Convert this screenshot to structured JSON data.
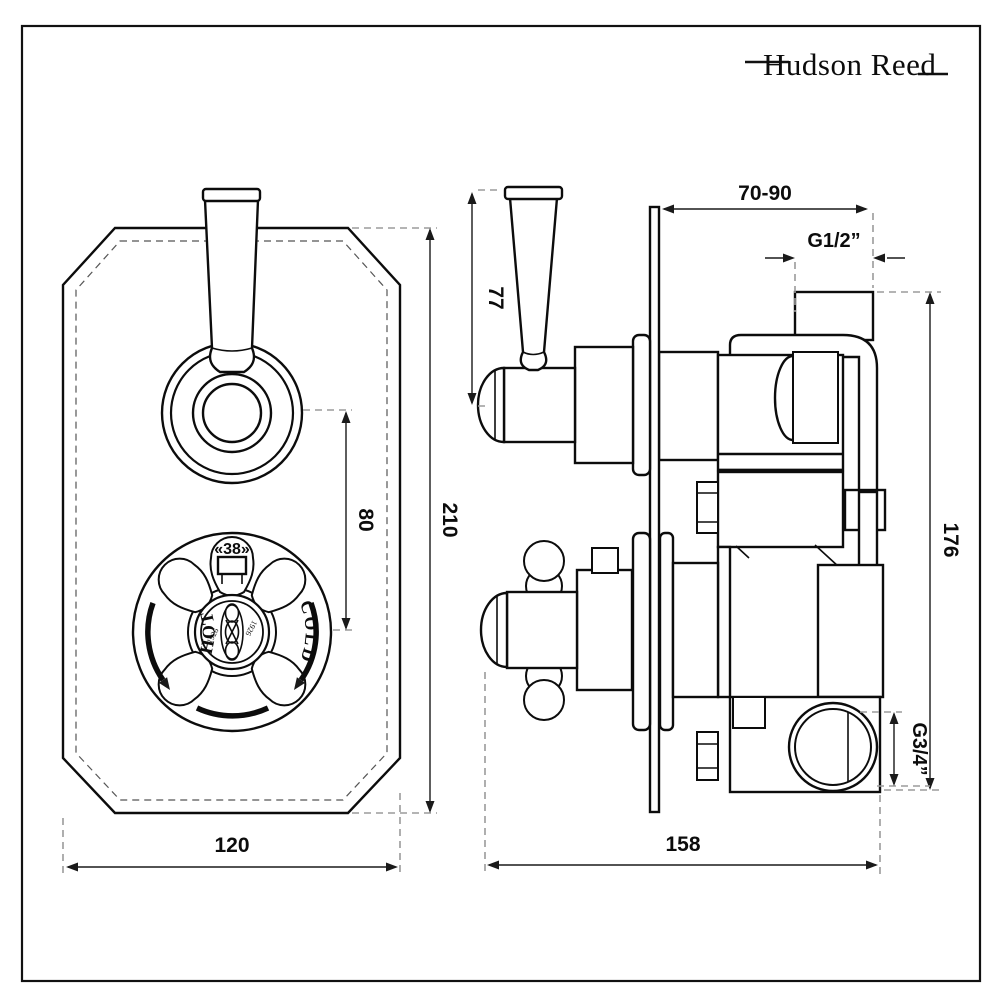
{
  "brand": {
    "logo_text": "Hudson Reed"
  },
  "front_view": {
    "hot_label": "HOT",
    "cold_label": "COLD",
    "temp_stop_label": "«38»",
    "medallion_year": "1926",
    "dim_width": "120",
    "dim_height": "210",
    "dim_control_spacing": "80"
  },
  "side_view": {
    "dim_handle_height": "77",
    "dim_wall_depth_range": "70-90",
    "dim_top_outlet_thread": "G1/2”",
    "dim_body_height": "176",
    "dim_bottom_outlet_thread": "G3/4”",
    "dim_total_depth": "158"
  }
}
